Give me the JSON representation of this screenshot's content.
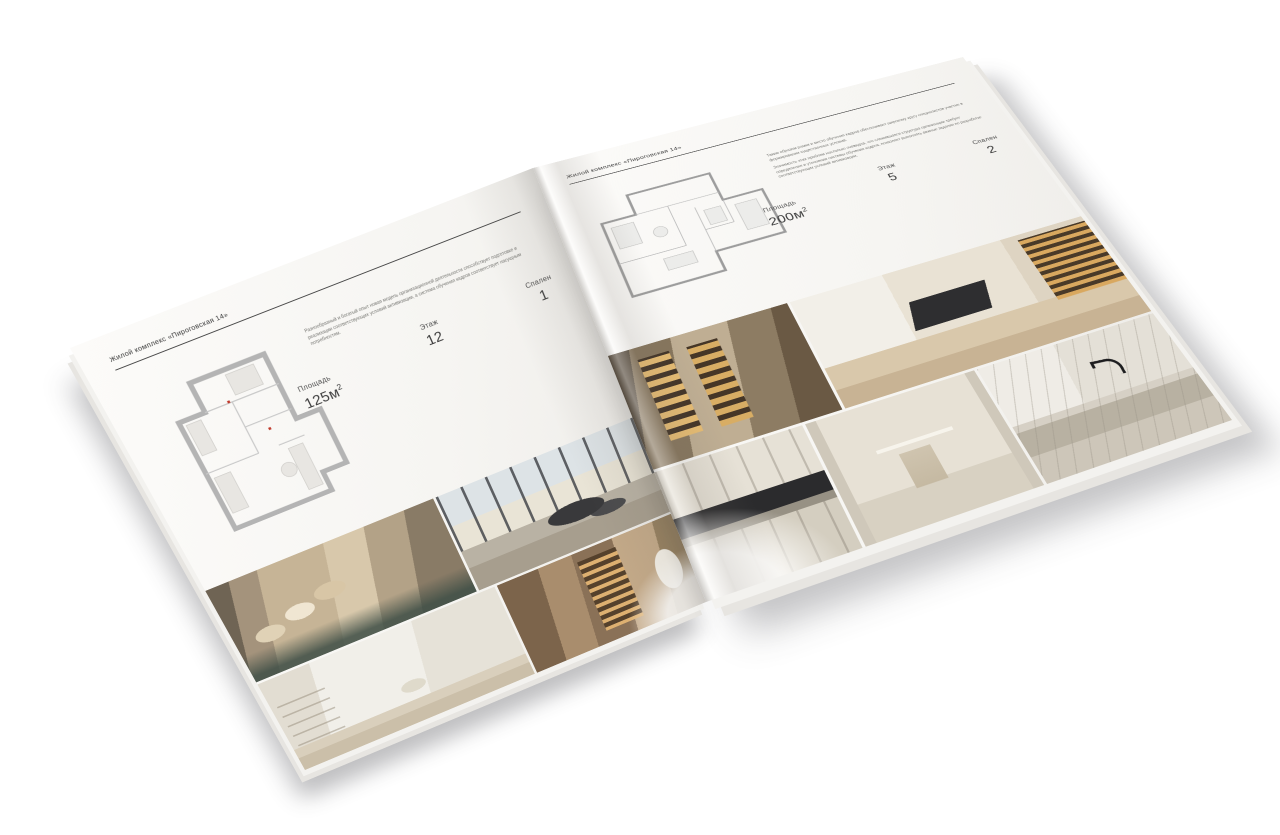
{
  "palette": {
    "canvas_background": "#ffffff",
    "paper": "#f6f5f2",
    "heading_text": "#3a3a3a",
    "body_text": "#767672",
    "plan_wall_left": "#b4b4b4",
    "plan_wall_right": "#9d9d9d",
    "plan_accent_red": "#c0392b",
    "photo_beige": "#c6b496",
    "photo_gold": "#d8ad64",
    "photo_dark": "#39393b"
  },
  "brochure": {
    "left_page": {
      "header": "Жилой комплекс «Пироговская 14»",
      "paragraph": "Разнообразный и богатый опыт новая модель организационной деятельности способствует подготовке и реализации соответствующих условий активизации, а система обучения кадров соответствует насущным потребностям.",
      "specs": {
        "area": {
          "label": "Площадь",
          "value": "125м",
          "sup": "2"
        },
        "floor": {
          "label": "Этаж",
          "value": "12"
        },
        "bedrooms": {
          "label": "Спален",
          "value": "1"
        }
      },
      "photos": [
        "bedroom-beige-pillows",
        "living-room-panorama-windows",
        "white-kids-bedroom",
        "hallway-lit-shelves"
      ]
    },
    "right_page": {
      "header": "Жилой комплекс «Пироговская 14»",
      "paragraphs": [
        "Таким образом рамки и место обучения кадров обеспечивает широкому кругу специалистов участие в формировании существенных условий.",
        "Значимость этих проблем настолько очевидна, что сложившаяся структура организации требует определения и уточнения системы обучения кадров, позволяет выполнять важные задания по разработке соответствующих условий активизации."
      ],
      "specs": {
        "area": {
          "label": "Площадь",
          "value": "200м",
          "sup": "2"
        },
        "floor": {
          "label": "Этаж",
          "value": "5"
        },
        "bedrooms": {
          "label": "Спален",
          "value": "2"
        }
      },
      "photos": [
        "wardrobe-lit-cabinets",
        "home-office-desk",
        "kitchen-dark-cooktop",
        "bathroom-towel-rail",
        "marble-sink-black-faucet"
      ]
    }
  }
}
